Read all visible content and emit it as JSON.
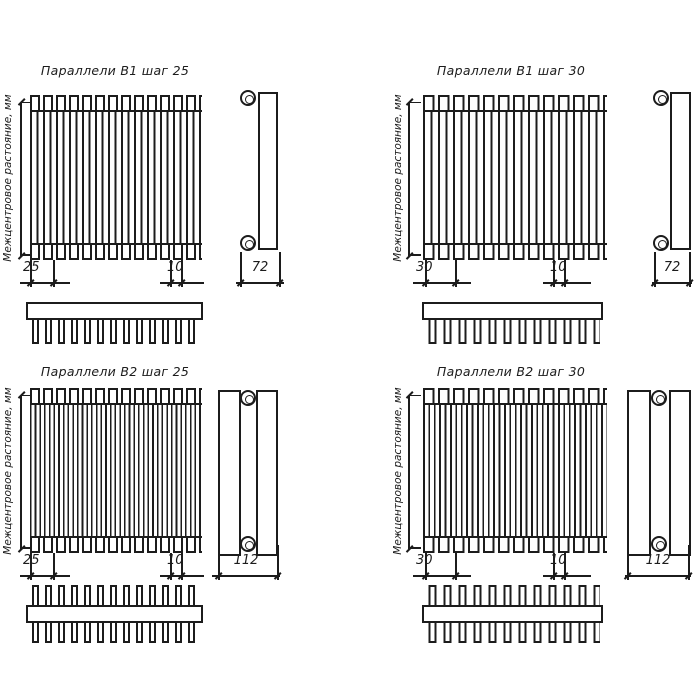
{
  "drawing": {
    "background_color": "#ffffff",
    "line_color": "#1c1c1c",
    "axis_label": "Межцентровое растояние, мм",
    "quadrants": [
      {
        "id": "b1-step-25",
        "title": "Параллели В1 шаг 25",
        "dim_step": "25",
        "dim_end": "10",
        "dim_depth": "72"
      },
      {
        "id": "b1-step-30",
        "title": "Параллели В1 шаг 30",
        "dim_step": "30",
        "dim_end": "10",
        "dim_depth": "72"
      },
      {
        "id": "b2-step-25",
        "title": "Параллели В2 шаг 25",
        "dim_step": "25",
        "dim_end": "10",
        "dim_depth": "112"
      },
      {
        "id": "b2-step-30",
        "title": "Параллели В2 шаг 30",
        "dim_step": "30",
        "dim_end": "10",
        "dim_depth": "112"
      }
    ]
  }
}
